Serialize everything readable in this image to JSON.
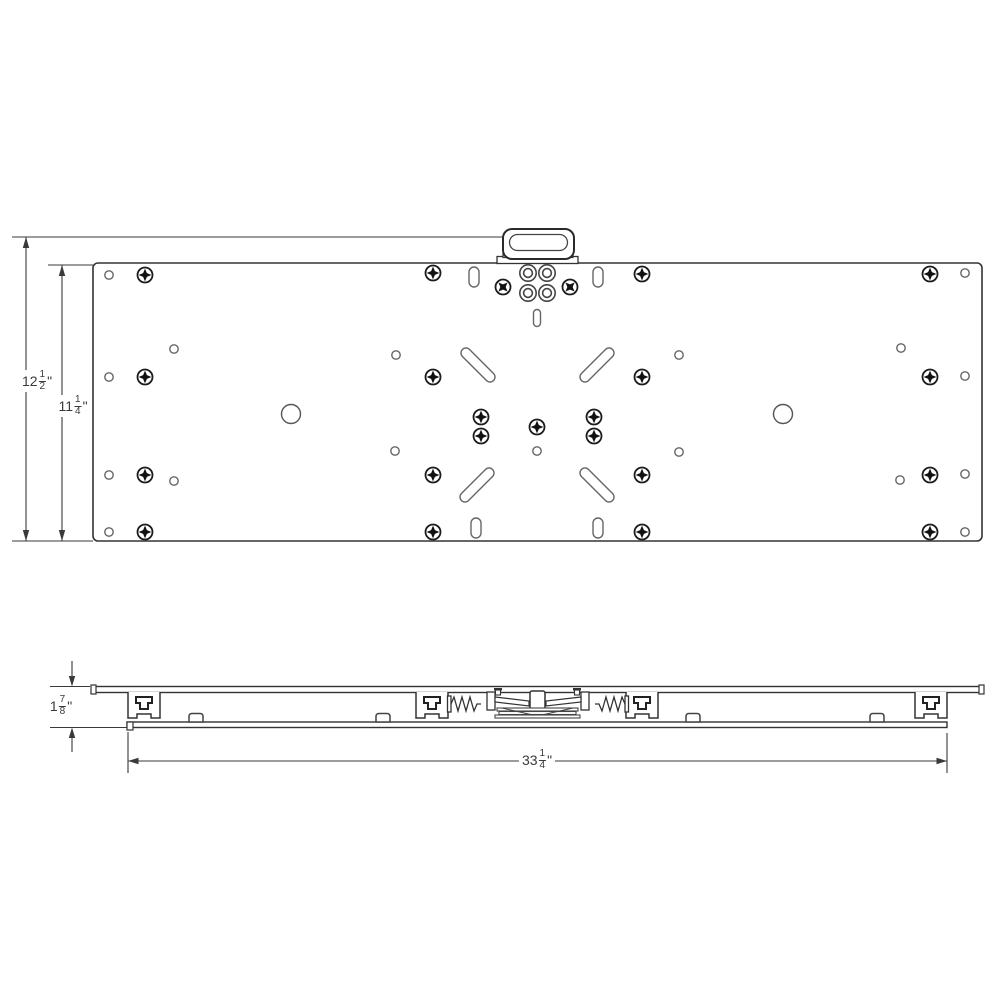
{
  "drawing": {
    "type": "mechanical-dimension-drawing",
    "views": {
      "top_view_name": "plate top view",
      "side_view_name": "assembly side view"
    },
    "colors": {
      "line": "#3a3a3a",
      "hole_line": "#666666",
      "screw_fill": "#111111",
      "background": "#ffffff"
    }
  },
  "dimensions": {
    "overall_height": {
      "whole": "12",
      "numerator": "1",
      "denominator": "2",
      "unit": "\""
    },
    "plate_height": {
      "whole": "11",
      "numerator": "1",
      "denominator": "4",
      "unit": "\""
    },
    "assembly_height": {
      "whole": "1",
      "numerator": "7",
      "denominator": "8",
      "unit": "\""
    },
    "overall_width": {
      "whole": "33",
      "numerator": "1",
      "denominator": "4",
      "unit": "\""
    }
  }
}
